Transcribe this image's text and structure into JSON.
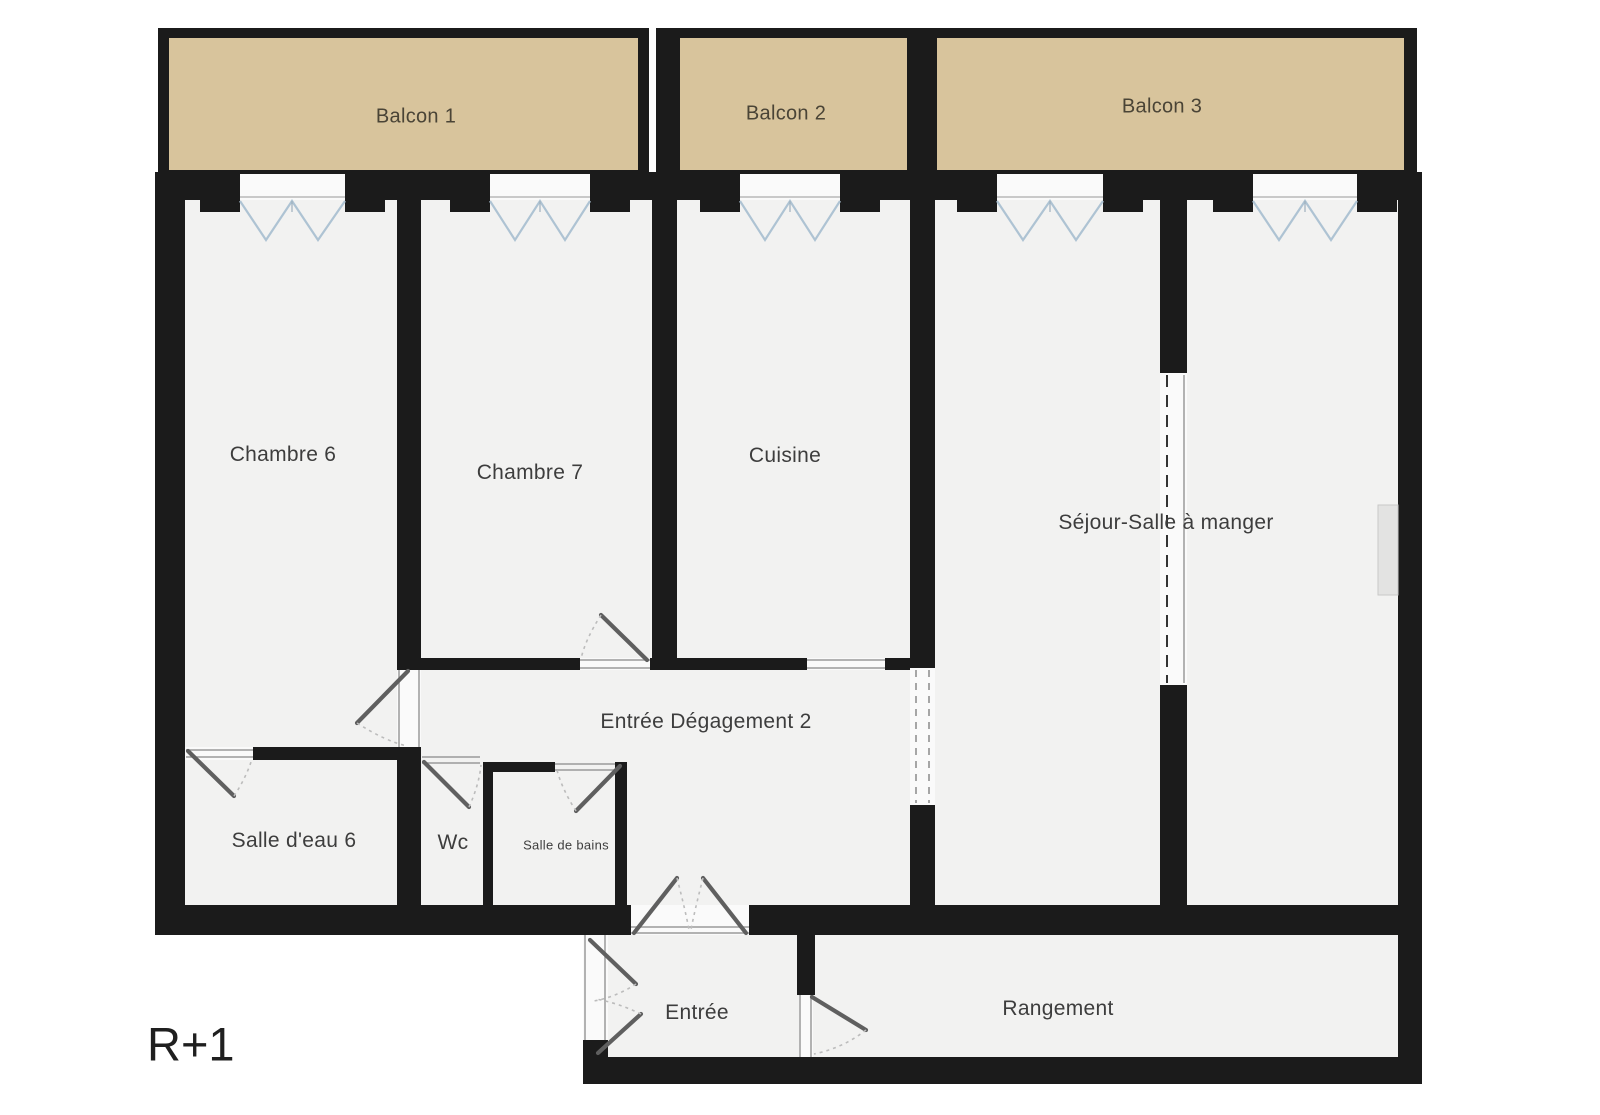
{
  "floor_plan": {
    "floor_label": "R+1",
    "rooms": {
      "balcon_1": {
        "label": "Balcon 1"
      },
      "balcon_2": {
        "label": "Balcon 2"
      },
      "balcon_3": {
        "label": "Balcon 3"
      },
      "chambre_6": {
        "label": "Chambre 6"
      },
      "chambre_7": {
        "label": "Chambre 7"
      },
      "cuisine": {
        "label": "Cuisine"
      },
      "sejour": {
        "label": "Séjour-Salle à manger"
      },
      "degagement": {
        "label": "Entrée Dégagement 2"
      },
      "salle_deau_6": {
        "label": "Salle d'eau 6"
      },
      "wc": {
        "label": "Wc"
      },
      "salle_de_bains": {
        "label": "Salle de bains"
      },
      "entree": {
        "label": "Entrée"
      },
      "rangement": {
        "label": "Rangement"
      }
    },
    "colors": {
      "wall": "#1b1b1b",
      "balcony_fill": "#d8c49c",
      "room_fill": "#f2f2f1",
      "window_symbol": "#aec3d3",
      "door": "#5f5f5f",
      "arc": "#bcbcbc",
      "frame_line": "#9a9a9a",
      "label": "#3d3d3d",
      "background": "#ffffff"
    }
  }
}
